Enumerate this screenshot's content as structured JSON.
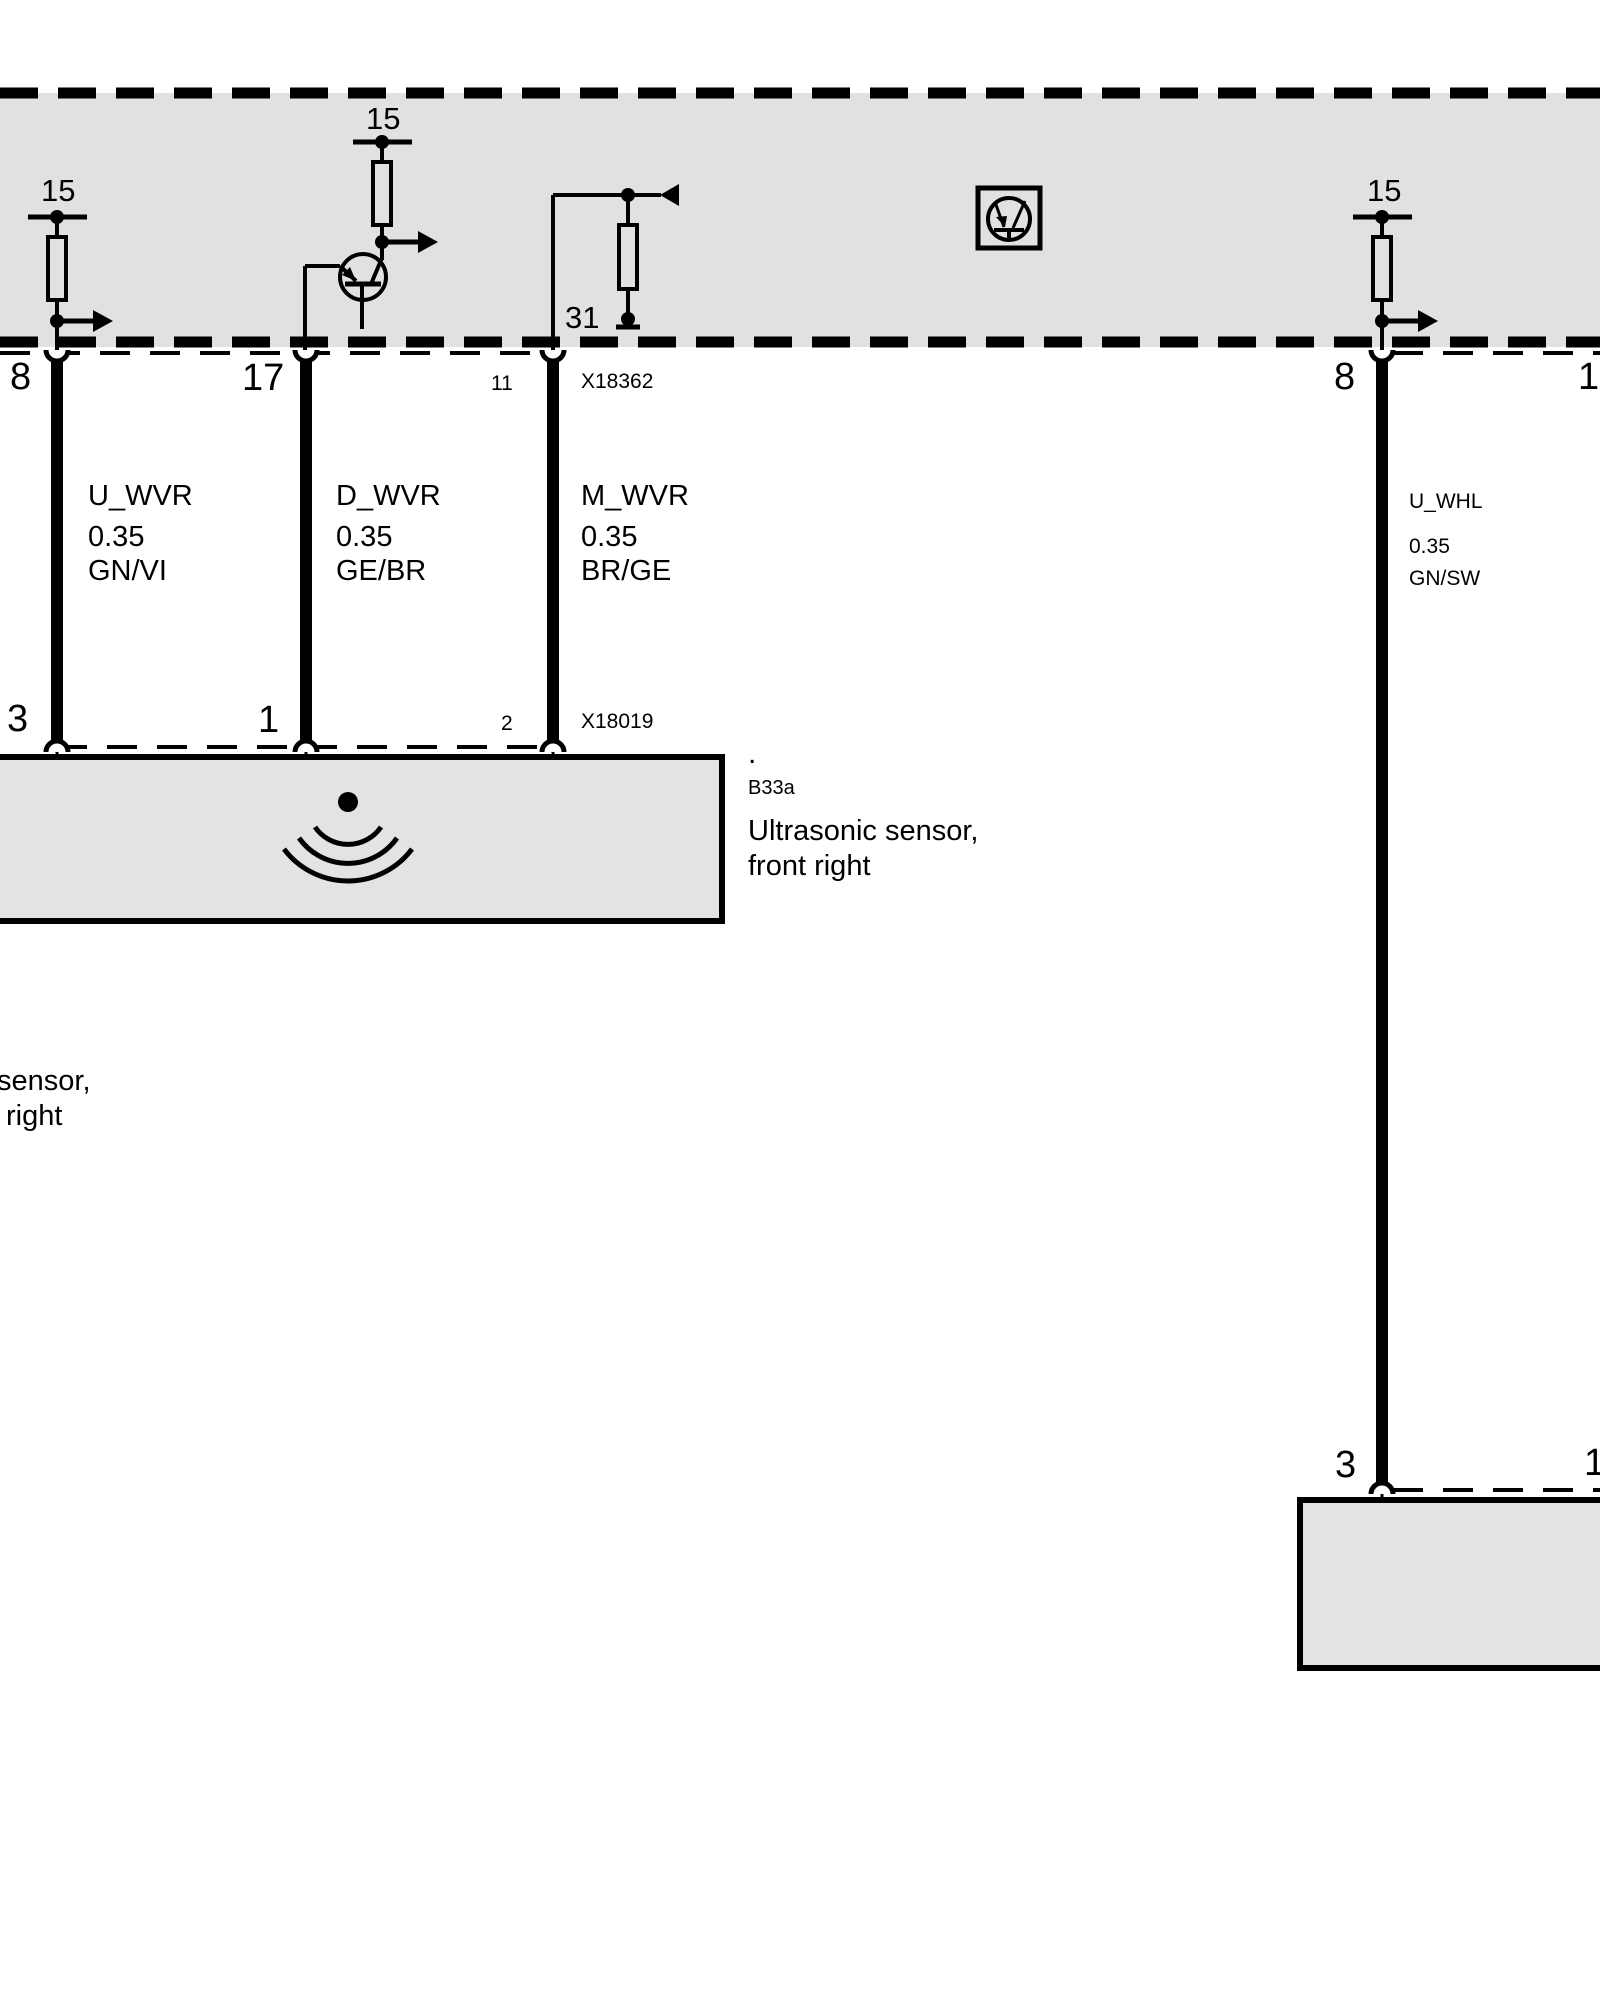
{
  "meta": {
    "diagram_type": "wiring-diagram",
    "colors": {
      "band": "#e1e1e1",
      "box": "#e3e3e3",
      "line": "#000000",
      "background": "#ffffff"
    }
  },
  "icons": {
    "fuse_left": "fuse-resistor-icon",
    "fuse_center": "fuse-resistor-icon",
    "fuse_right": "fuse-resistor-icon",
    "transistor": "transistor-icon",
    "ground": "ground-icon",
    "electronic_switch": "electronic-switch-icon",
    "ultrasonic": "ultrasonic-waves-icon",
    "signal_out": "arrow-right-icon",
    "signal_in": "arrow-left-icon"
  },
  "labels": {
    "t15_left": "15",
    "t15_center": "15",
    "t15_right": "15",
    "t31": "31",
    "pin8_tl": "8",
    "pin17_tl": "17",
    "pin11_tl": "11",
    "conn_x18362": "X18362",
    "w1_signal": "U_WVR",
    "w1_size": "0.35",
    "w1_color": "GN/VI",
    "w2_signal": "D_WVR",
    "w2_size": "0.35",
    "w2_color": "GE/BR",
    "w3_signal": "M_WVR",
    "w3_size": "0.35",
    "w3_color": "BR/GE",
    "pin3_bl": "3",
    "pin1_bl": "1",
    "pin2_bl": "2",
    "conn_x18019": "X18019",
    "note_dot": ".",
    "sensor_code": "B33a",
    "sensor_name_1": "Ultrasonic sensor,",
    "sensor_name_2": "front right",
    "clipped_1": "sensor,",
    "clipped_2": "right",
    "pin8_tr": "8",
    "pin17_tr": "17",
    "wr_signal": "U_WHL",
    "wr_size": "0.35",
    "wr_color": "GN/SW",
    "pin3_br": "3",
    "pin1_br": "1"
  }
}
